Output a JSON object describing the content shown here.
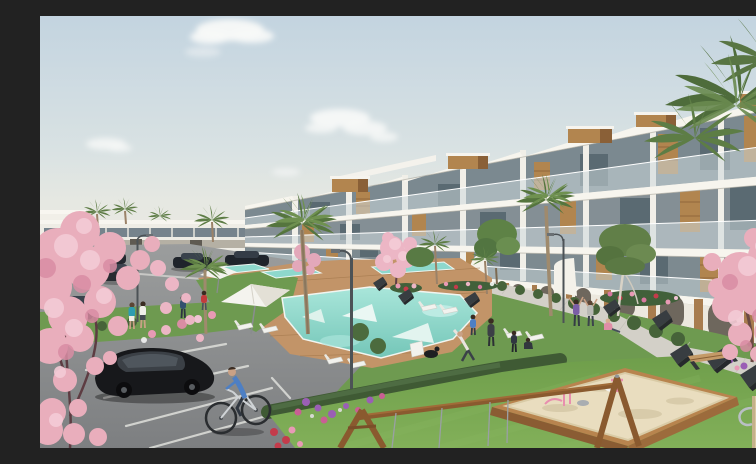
{
  "meta": {
    "title": "Architectural rendering of a new-build white apartment complex with communal pool, gardens, parking and playground",
    "aria_label": "3D visualization: terraced white apartments with wood accents, palm trees, pink blossom trees, turquoise pools, parking lot with cars, cyclist, lawns, sandbox and swing set"
  },
  "palette": {
    "sky_top": "#c3d4e0",
    "sky_horizon": "#ebe9e1",
    "cloud": "#f8f9f8",
    "building_white": "#f2f0e9",
    "slab_white": "#f7f5ee",
    "glass_dark": "#5f7077",
    "glass_band": "#7b8990",
    "balustrade": "#c9d6da",
    "wood_accent": "#b1854f",
    "wood_dark": "#8a6037",
    "lawn_mid": "#6e9a50",
    "lawn_foreground": "#79a754",
    "hedge_dark": "#3f5a34",
    "deck_wood": "#c29468",
    "pool_water": "#8fd9cc",
    "pool_deep": "#74c6b8",
    "pool_steps": "#eaf7f3",
    "path_gray": "#d3d0c8",
    "asphalt": "#8b8d8e",
    "blossom_pink": "#ecb6c5",
    "blossom_light": "#f5ced8",
    "blossom_shadow": "#d98da4",
    "sand": "#e9ddbf",
    "swing_wood": "#8a5a2f",
    "play_wood_pale": "#d9c7a2",
    "car_black": "#17181b",
    "cyclist_blue": "#4d7fc4",
    "lamp_gray": "#4c5256"
  },
  "scene_inventory": {
    "palm_trees": 11,
    "blossom_trees": 4,
    "green_trees": 5,
    "pools": 4,
    "umbrellas": 2,
    "sun_loungers": 8,
    "benches": 9,
    "street_lamps": 3,
    "cars": 6,
    "bicycles": 1,
    "people": 13,
    "dogs": 1,
    "sandbox": 1,
    "swing_set": 1,
    "clouds": 5
  }
}
